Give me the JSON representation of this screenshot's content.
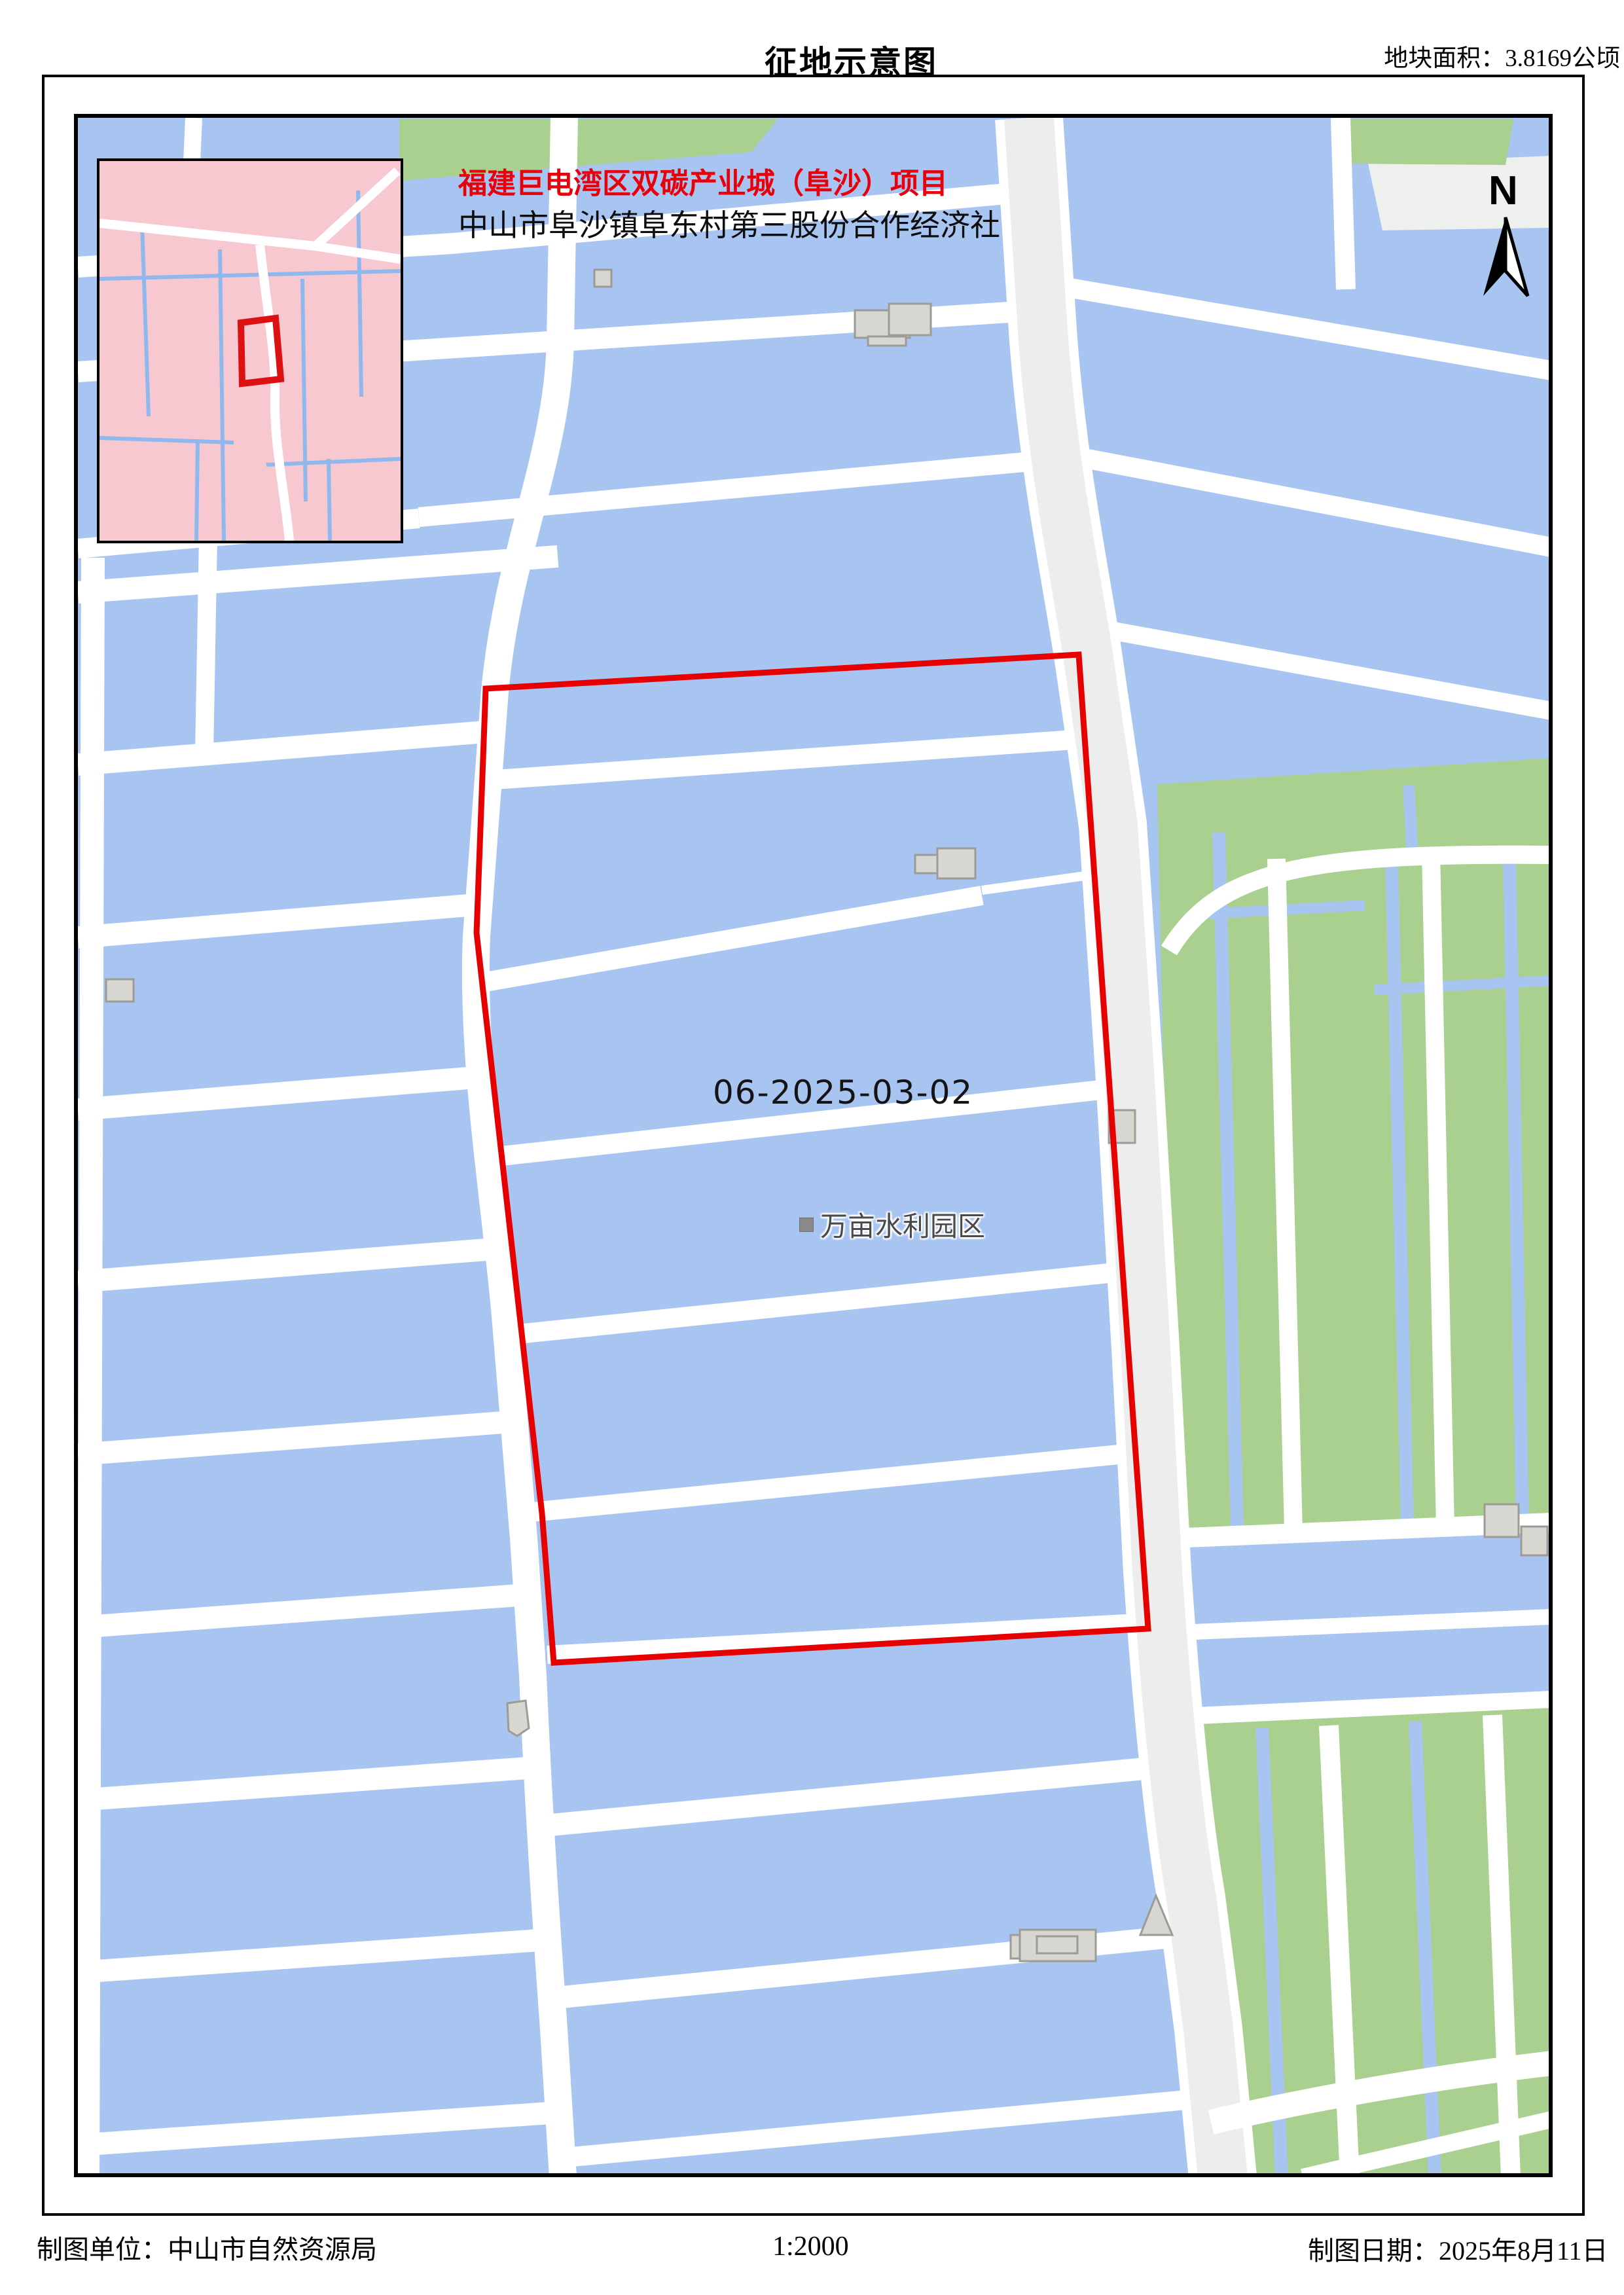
{
  "page": {
    "title": "征地示意图",
    "area_label": "地块面积：3.8169公顷",
    "footer": {
      "agency": "制图单位：中山市自然资源局",
      "scale": "1:2000",
      "date": "制图日期：2025年8月11日"
    }
  },
  "map": {
    "project_title": "福建巨电湾区双碳产业城（阜沙）项目",
    "project_subtitle": "中山市阜沙镇阜东村第三股份合作经济社",
    "parcel_id": "06-2025-03-02",
    "poi_label": "万亩水利园区",
    "north_label": "N",
    "colors": {
      "water": "#a8c4f1",
      "green": "#a9d08e",
      "road": "#ffffff",
      "grayroad": "#ededed",
      "pale": "#eef0ee",
      "pink": "#f8c8d0",
      "canal_blue": "#8fb9ee",
      "red_outline": "#e60000",
      "inset_red": "#dd1111",
      "building_fill": "#d8d6d1",
      "building_stroke": "#9d9b96",
      "project_title_red": "#e8000a",
      "poi_gray": "#4a4a4a"
    }
  }
}
